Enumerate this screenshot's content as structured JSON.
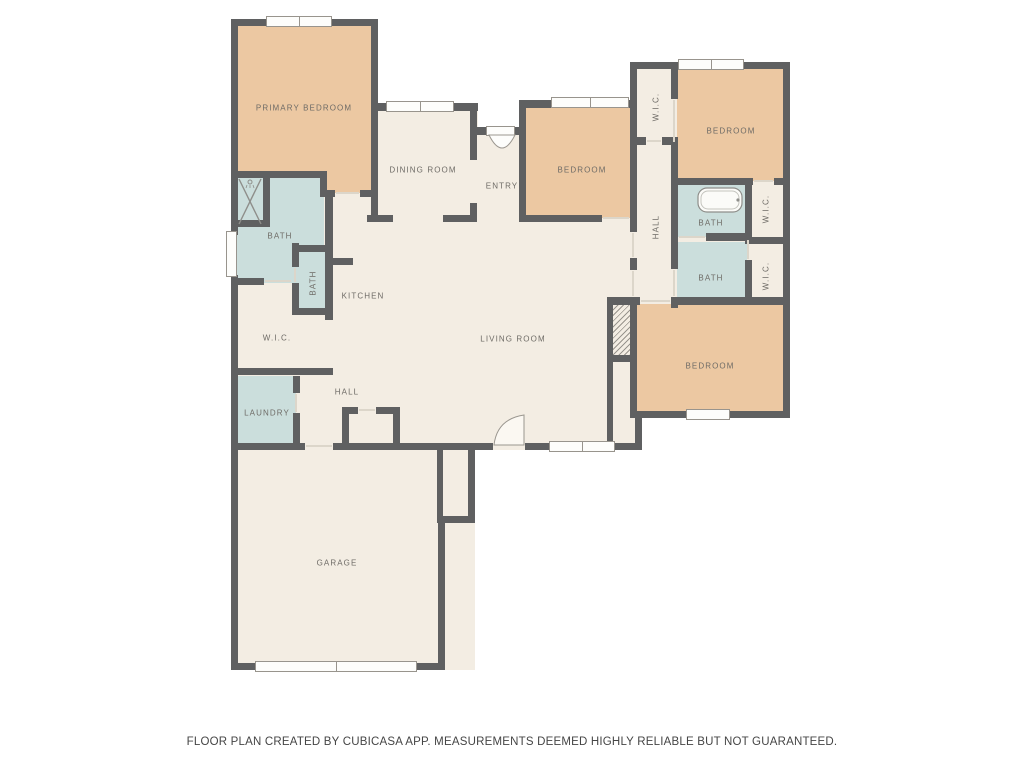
{
  "palette": {
    "background": "#FFFFFF",
    "floor_cream": "#F3EDE3",
    "bedroom_tan": "#ECC8A2",
    "bath_blue": "#CBDEDC",
    "wall_gray": "#5F6061",
    "window_white": "#FDFDFB",
    "label_gray": "#6E6B66"
  },
  "rooms": {
    "primary_bedroom": {
      "label": "PRIMARY BEDROOM"
    },
    "dining_room": {
      "label": "DINING ROOM"
    },
    "entry": {
      "label": "ENTRY"
    },
    "bedroom_center": {
      "label": "BEDROOM"
    },
    "bedroom_top_right": {
      "label": "BEDROOM"
    },
    "bedroom_bottom_right": {
      "label": "BEDROOM"
    },
    "bath_left": {
      "label": "BATH"
    },
    "bath_left_small": {
      "label": "BATH"
    },
    "kitchen": {
      "label": "KITCHEN"
    },
    "wic_left": {
      "label": "W.I.C."
    },
    "laundry": {
      "label": "LAUNDRY"
    },
    "hall_left": {
      "label": "HALL"
    },
    "hall_right": {
      "label": "HALL"
    },
    "wic_top_right": {
      "label": "W.I.C."
    },
    "bath_right_upper": {
      "label": "BATH"
    },
    "bath_right_lower": {
      "label": "BATH"
    },
    "wic_right_upper": {
      "label": "W.I.C."
    },
    "wic_right_lower": {
      "label": "W.I.C."
    },
    "living_room": {
      "label": "LIVING ROOM"
    },
    "garage": {
      "label": "GARAGE"
    }
  },
  "footer": {
    "disclaimer": "FLOOR PLAN CREATED BY CUBICASA APP. MEASUREMENTS DEEMED HIGHLY RELIABLE BUT NOT GUARANTEED."
  }
}
